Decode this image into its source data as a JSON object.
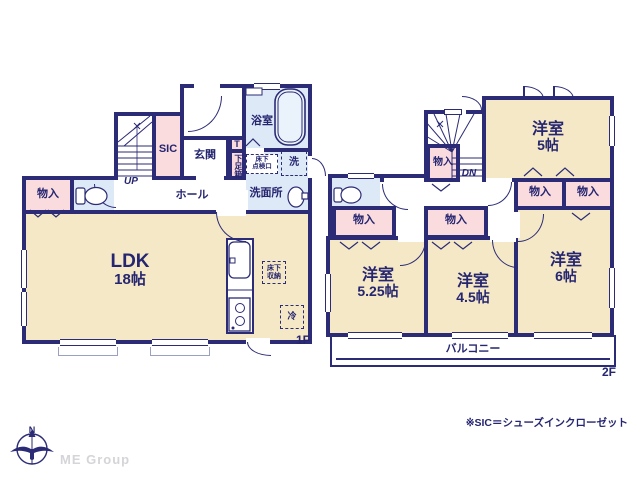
{
  "meta": {
    "floor1_tag": "1F",
    "floor2_tag": "2F"
  },
  "labels": {
    "closet": "物入",
    "up": "UP",
    "down": "DN",
    "hall": "ホール",
    "entrance": "玄関",
    "sic": "SIC",
    "bath": "浴室",
    "washroom": "洗面所",
    "laundry": "洗",
    "shoe_t": "T",
    "shoe_box": "下足箱",
    "inspection_line1": "床下",
    "inspection_line2": "点検口",
    "underfloor_line1": "床下",
    "underfloor_line2": "収納",
    "fridge": "冷",
    "balcony": "バルコニー"
  },
  "rooms": {
    "ldk": {
      "name": "LDK",
      "size": "18帖"
    },
    "west_room_5": {
      "name": "洋室",
      "size": "5帖"
    },
    "west_room_525": {
      "name": "洋室",
      "size": "5.25帖"
    },
    "west_room_45": {
      "name": "洋室",
      "size": "4.5帖"
    },
    "west_room_6": {
      "name": "洋室",
      "size": "6帖"
    }
  },
  "colors": {
    "wall": "#2b2b76",
    "room_cream": "#f5e8c6",
    "closet_pink": "#fadcdf",
    "wet_blue": "#dde9f6",
    "text_navy": "#252570"
  },
  "footer": {
    "note": "※SIC＝シューズインクローゼット",
    "compass_north": "N",
    "brand": "ME Group"
  }
}
